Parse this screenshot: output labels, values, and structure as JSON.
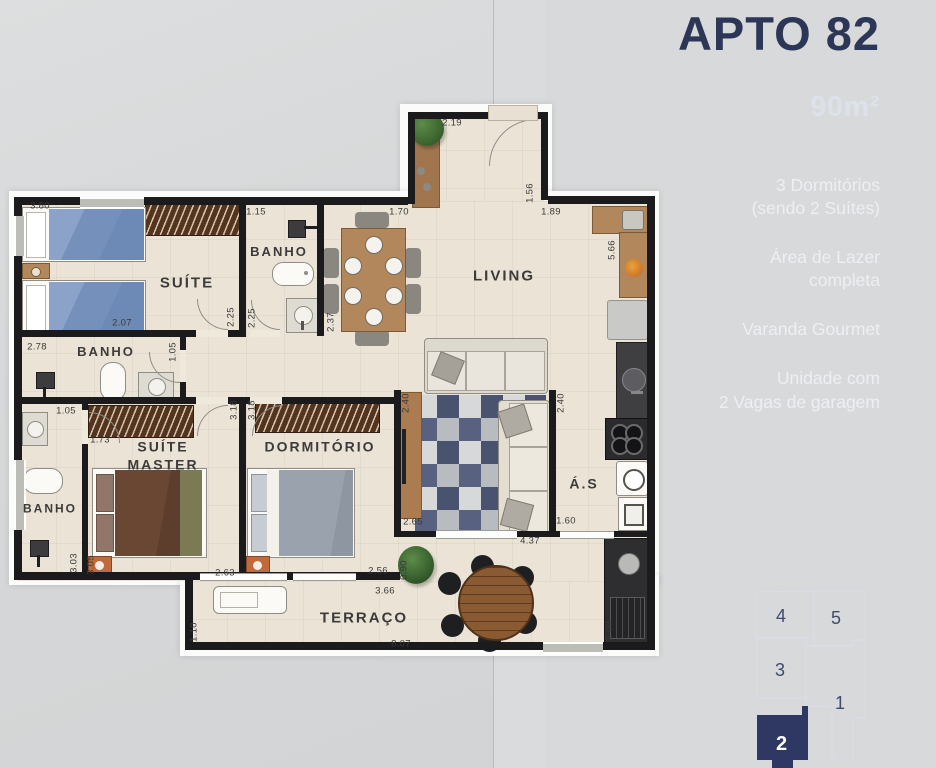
{
  "panel": {
    "title": "APTO 82",
    "area_label": "90m²",
    "features": [
      {
        "text": "3 Dormitórios\n(sendo 2 Suítes)"
      },
      {
        "text": "Área de Lazer\ncompleta"
      },
      {
        "text": "Varanda Gourmet"
      },
      {
        "text": "Unidade com\n2 Vagas de garagem"
      }
    ]
  },
  "colors": {
    "accent_navy": "#2c3657",
    "keyplan_highlight": "#2f3763",
    "wall": "#1b1b1d",
    "floor": "#ebe4d6",
    "photo_blue": "#8795b0"
  },
  "keyplan": {
    "units": [
      {
        "label": "4",
        "highlighted": false
      },
      {
        "label": "5",
        "highlighted": false
      },
      {
        "label": "3",
        "highlighted": false
      },
      {
        "label": "1",
        "highlighted": false
      },
      {
        "label": "2",
        "highlighted": true
      }
    ]
  },
  "plan": {
    "rooms": [
      {
        "label": "SUÍTE",
        "x": 187,
        "y": 284,
        "fs": 15
      },
      {
        "label": "BANHO",
        "x": 279,
        "y": 252,
        "fs": 13
      },
      {
        "label": "BANHO",
        "x": 106,
        "y": 352,
        "fs": 13
      },
      {
        "label": "LIVING",
        "x": 504,
        "y": 277,
        "fs": 15
      },
      {
        "label": "SUÍTE\nMASTER",
        "x": 163,
        "y": 456,
        "fs": 14
      },
      {
        "label": "DORMITÓRIO",
        "x": 320,
        "y": 447,
        "fs": 14
      },
      {
        "label": "BANHO",
        "x": 50,
        "y": 509,
        "fs": 12
      },
      {
        "label": "Á.S",
        "x": 584,
        "y": 484,
        "fs": 14
      },
      {
        "label": "TERRAÇO",
        "x": 364,
        "y": 619,
        "fs": 15
      }
    ],
    "dims": [
      {
        "t": "3.80",
        "x": 40,
        "y": 206,
        "v": false
      },
      {
        "t": "2.07",
        "x": 122,
        "y": 323,
        "v": false
      },
      {
        "t": "2.25",
        "x": 231,
        "y": 317,
        "v": true
      },
      {
        "t": "2.25",
        "x": 252,
        "y": 318,
        "v": true
      },
      {
        "t": "1.15",
        "x": 256,
        "y": 212,
        "v": false
      },
      {
        "t": "1.70",
        "x": 399,
        "y": 212,
        "v": false
      },
      {
        "t": "2.37",
        "x": 331,
        "y": 322,
        "v": true
      },
      {
        "t": "2.19",
        "x": 452,
        "y": 123,
        "v": false
      },
      {
        "t": "1.56",
        "x": 530,
        "y": 193,
        "v": true
      },
      {
        "t": "1.89",
        "x": 551,
        "y": 212,
        "v": false
      },
      {
        "t": "5.66",
        "x": 612,
        "y": 250,
        "v": true
      },
      {
        "t": "2.78",
        "x": 37,
        "y": 347,
        "v": false
      },
      {
        "t": "1.05",
        "x": 173,
        "y": 352,
        "v": true
      },
      {
        "t": "1.05",
        "x": 66,
        "y": 411,
        "v": false
      },
      {
        "t": "1.73",
        "x": 100,
        "y": 440,
        "v": false
      },
      {
        "t": "3.18",
        "x": 234,
        "y": 410,
        "v": true
      },
      {
        "t": "3.18",
        "x": 252,
        "y": 410,
        "v": true
      },
      {
        "t": "2.40",
        "x": 406,
        "y": 403,
        "v": true
      },
      {
        "t": "2.40",
        "x": 561,
        "y": 403,
        "v": true
      },
      {
        "t": "3.03",
        "x": 74,
        "y": 563,
        "v": true
      },
      {
        "t": "3.05",
        "x": 91,
        "y": 565,
        "v": true
      },
      {
        "t": "2.63",
        "x": 225,
        "y": 573,
        "v": false
      },
      {
        "t": "2.56",
        "x": 378,
        "y": 571,
        "v": false
      },
      {
        "t": "2.65",
        "x": 413,
        "y": 522,
        "v": false
      },
      {
        "t": "1.60",
        "x": 566,
        "y": 521,
        "v": false
      },
      {
        "t": "4.37",
        "x": 530,
        "y": 541,
        "v": false
      },
      {
        "t": "0.90",
        "x": 404,
        "y": 570,
        "v": true
      },
      {
        "t": "3.66",
        "x": 385,
        "y": 591,
        "v": false
      },
      {
        "t": "8.07",
        "x": 401,
        "y": 644,
        "v": false
      },
      {
        "t": "1.10",
        "x": 194,
        "y": 632,
        "v": true
      },
      {
        "t": "2.00",
        "x": 609,
        "y": 631,
        "v": true
      }
    ]
  }
}
